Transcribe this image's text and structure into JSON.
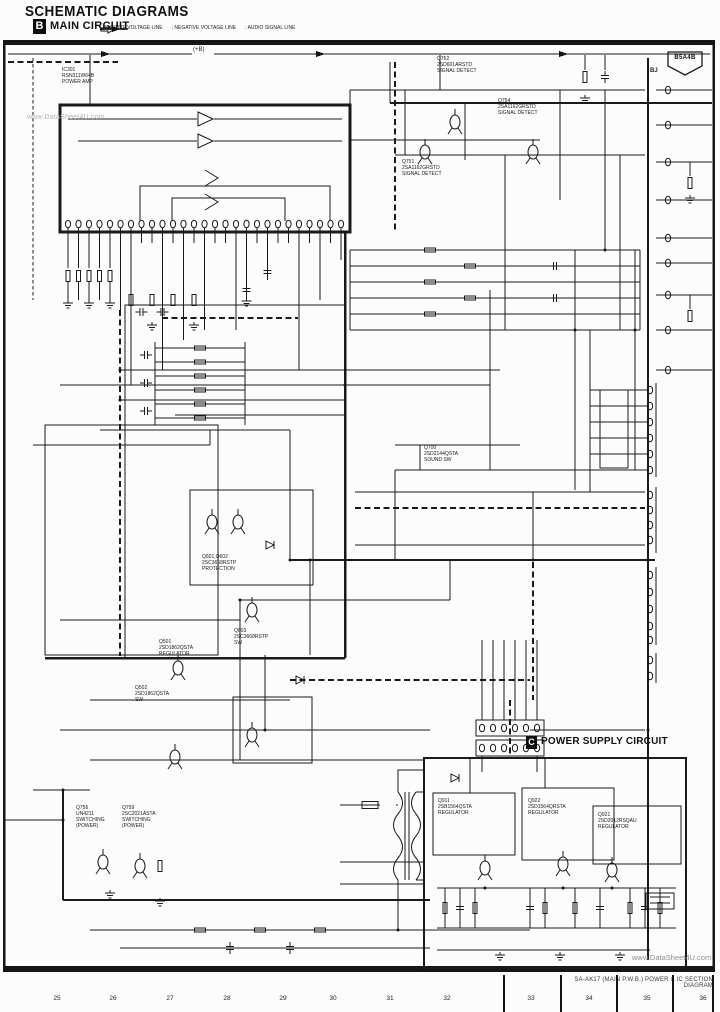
{
  "page": {
    "title": "SCHEMATIC DIAGRAMS",
    "section_main": {
      "badge": "B",
      "label": "MAIN CIRCUIT"
    },
    "section_power": {
      "badge": "C",
      "label": "POWER SUPPLY CIRCUIT"
    },
    "legend": [
      {
        "icon": "solid-arrow",
        "label": ": POSITIVE VOLTAGE LINE"
      },
      {
        "icon": "dashed-arrow",
        "label": ": NEGATIVE VOLTAGE LINE"
      },
      {
        "icon": "open-arrow",
        "label": ": AUDIO SIGNAL LINE"
      }
    ],
    "page_ref": "B5A4B",
    "corner_note": "BJ",
    "plus_b_label": "(+B)",
    "watermark_top": "www.DataSheet4U.com",
    "watermark_bottom": "www.DataSheet4U.com",
    "footer_caption": "SA-AK17 (MAIN P.W.B.) POWER & IC SECTION DIAGRAM",
    "ruler": [
      "25",
      "26",
      "27",
      "28",
      "29",
      "30",
      "31",
      "32",
      "33",
      "34",
      "35",
      "36"
    ],
    "colors": {
      "line": "#1a1a1a",
      "paper": "#fcfcfc",
      "watermark": "#b5b5b5"
    }
  },
  "components": {
    "ic301": {
      "l1": "IC301",
      "l2": "RSN311W64B",
      "l3": "POWER AMP"
    },
    "q752": {
      "l1": "Q752",
      "l2": "2SD601ARSTD",
      "l3": "SIGNAL DETECT"
    },
    "q754": {
      "l1": "Q754",
      "l2": "2SA1162GRSTD",
      "l3": "SIGNAL DETECT"
    },
    "q751": {
      "l1": "Q751",
      "l2": "2SA1162GRSTD",
      "l3": "SIGNAL DETECT"
    },
    "q700": {
      "l1": "Q700",
      "l2": "2SD2144QSTA",
      "l3": "SOUND SW"
    },
    "q601": {
      "l1": "Q601,Q602",
      "l2": "2SC3668RSTP",
      "l3": "PROTECTION"
    },
    "q603": {
      "l1": "Q603",
      "l2": "2SC3668RSTP",
      "l3": "SW"
    },
    "q501": {
      "l1": "Q501",
      "l2": "2SD1862QSTA",
      "l3": "REGULATOR"
    },
    "q502": {
      "l1": "Q502",
      "l2": "2SD1862QSTA",
      "l3": "SW"
    },
    "q756": {
      "l1": "Q756",
      "l2": "UN4211",
      "l3": "SWITCHING",
      "l4": "(POWER)"
    },
    "q759": {
      "l1": "Q759",
      "l2": "2SC2021ASTA",
      "l3": "SWITCHING",
      "l4": "(POWER)"
    },
    "q911": {
      "l1": "Q911",
      "l2": "2SB1564QSTA",
      "l3": "REGULATOR"
    },
    "q922": {
      "l1": "Q922",
      "l2": "2SD1564QRSTA",
      "l3": "REGULATOR"
    },
    "q921": {
      "l1": "Q921",
      "l2": "2SD2012RSQAU",
      "l3": "REGULATOR"
    }
  }
}
